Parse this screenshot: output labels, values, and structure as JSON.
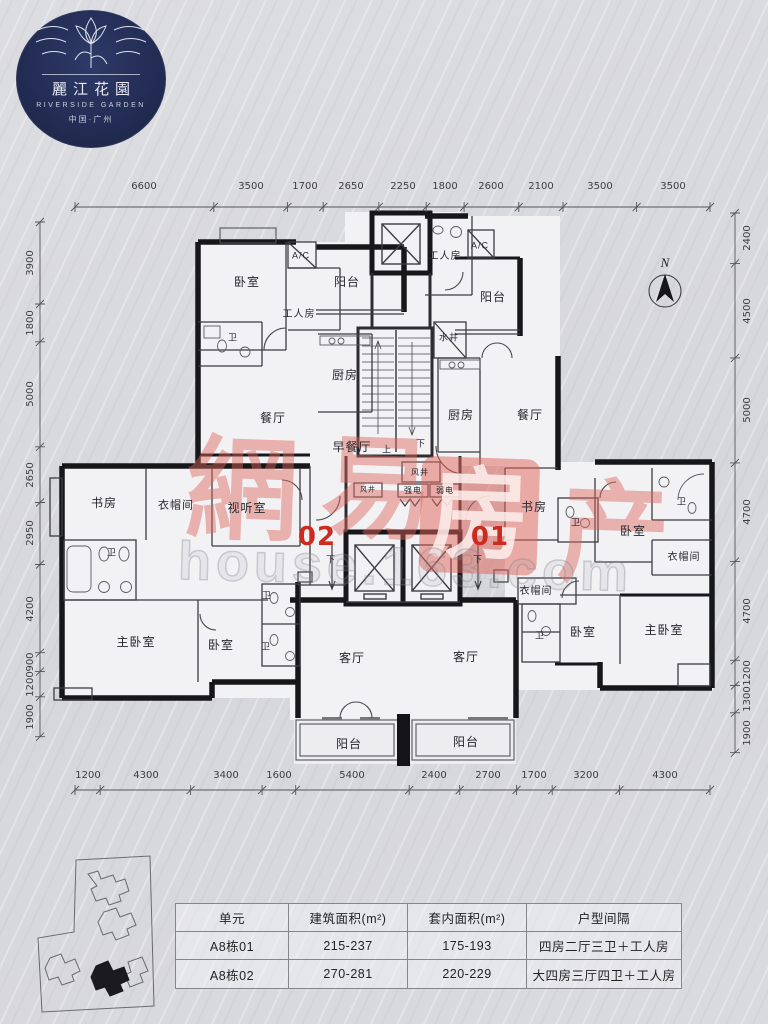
{
  "logo": {
    "name_cn": "麗江花園",
    "name_en": "RIVERSIDE GARDEN",
    "location": "中国·广州"
  },
  "compass": {
    "label": "N"
  },
  "watermark": {
    "c1": "網",
    "c2": "易",
    "c3": "房",
    "c4": "产",
    "url": "house.163.com"
  },
  "units": {
    "left": "02",
    "right": "01"
  },
  "rooms": {
    "bedroom_tl": "卧室",
    "ac_left": "A/C",
    "balcony_tl": "阳台",
    "worker_left": "工人房",
    "bath_tl": "卫",
    "kitchen_left": "厨房",
    "dining_left": "餐厅",
    "breakfast": "早餐厅",
    "worker_right": "工人房",
    "ac_right": "A/C",
    "balcony_tr": "阳台",
    "water_well": "水井",
    "kitchen_right": "厨房",
    "dining_right": "餐厅",
    "shaft_small": "风井",
    "shaft_big": "风井",
    "power_strong": "强电",
    "power_weak": "弱电",
    "up": "上",
    "down": "下",
    "down_l": "下",
    "down_r": "下",
    "study_left": "书房",
    "cloak_left": "衣帽间",
    "av_room": "视听室",
    "bath_left": "卫",
    "study_right": "书房",
    "bath_r1": "卫",
    "bath_r2": "卫",
    "bedroom_r": "卧室",
    "cloak_r1": "衣帽间",
    "master_left": "主卧室",
    "bedroom_bl": "卧室",
    "bath_bl1": "卫",
    "bath_bl2": "卫",
    "living_left": "客厅",
    "living_right": "客厅",
    "cloak_r2": "衣帽间",
    "bath_br": "卫",
    "bedroom_br": "卧室",
    "master_right": "主卧室",
    "balcony_bl": "阳台",
    "balcony_br": "阳台"
  },
  "dims": {
    "top": [
      "6600",
      "3500",
      "1700",
      "2650",
      "2250",
      "1800",
      "2600",
      "2100",
      "3500",
      "3500"
    ],
    "bottom": [
      "1200",
      "4300",
      "3400",
      "1600",
      "5400",
      "2400",
      "2700",
      "1700",
      "3200",
      "4300"
    ],
    "left": [
      "3900",
      "1800",
      "5000",
      "2650",
      "2950",
      "4200",
      "900",
      "1200",
      "1900"
    ],
    "right": [
      "2400",
      "4500",
      "5000",
      "4700",
      "4700",
      "1200",
      "1300",
      "1900"
    ]
  },
  "table": {
    "headers": [
      "单元",
      "建筑面积(m²)",
      "套内面积(m²)",
      "户型间隔"
    ],
    "rows": [
      [
        "A8栋01",
        "215-237",
        "175-193",
        "四房二厅三卫＋工人房"
      ],
      [
        "A8栋02",
        "270-281",
        "220-229",
        "大四房三厅四卫＋工人房"
      ]
    ]
  }
}
